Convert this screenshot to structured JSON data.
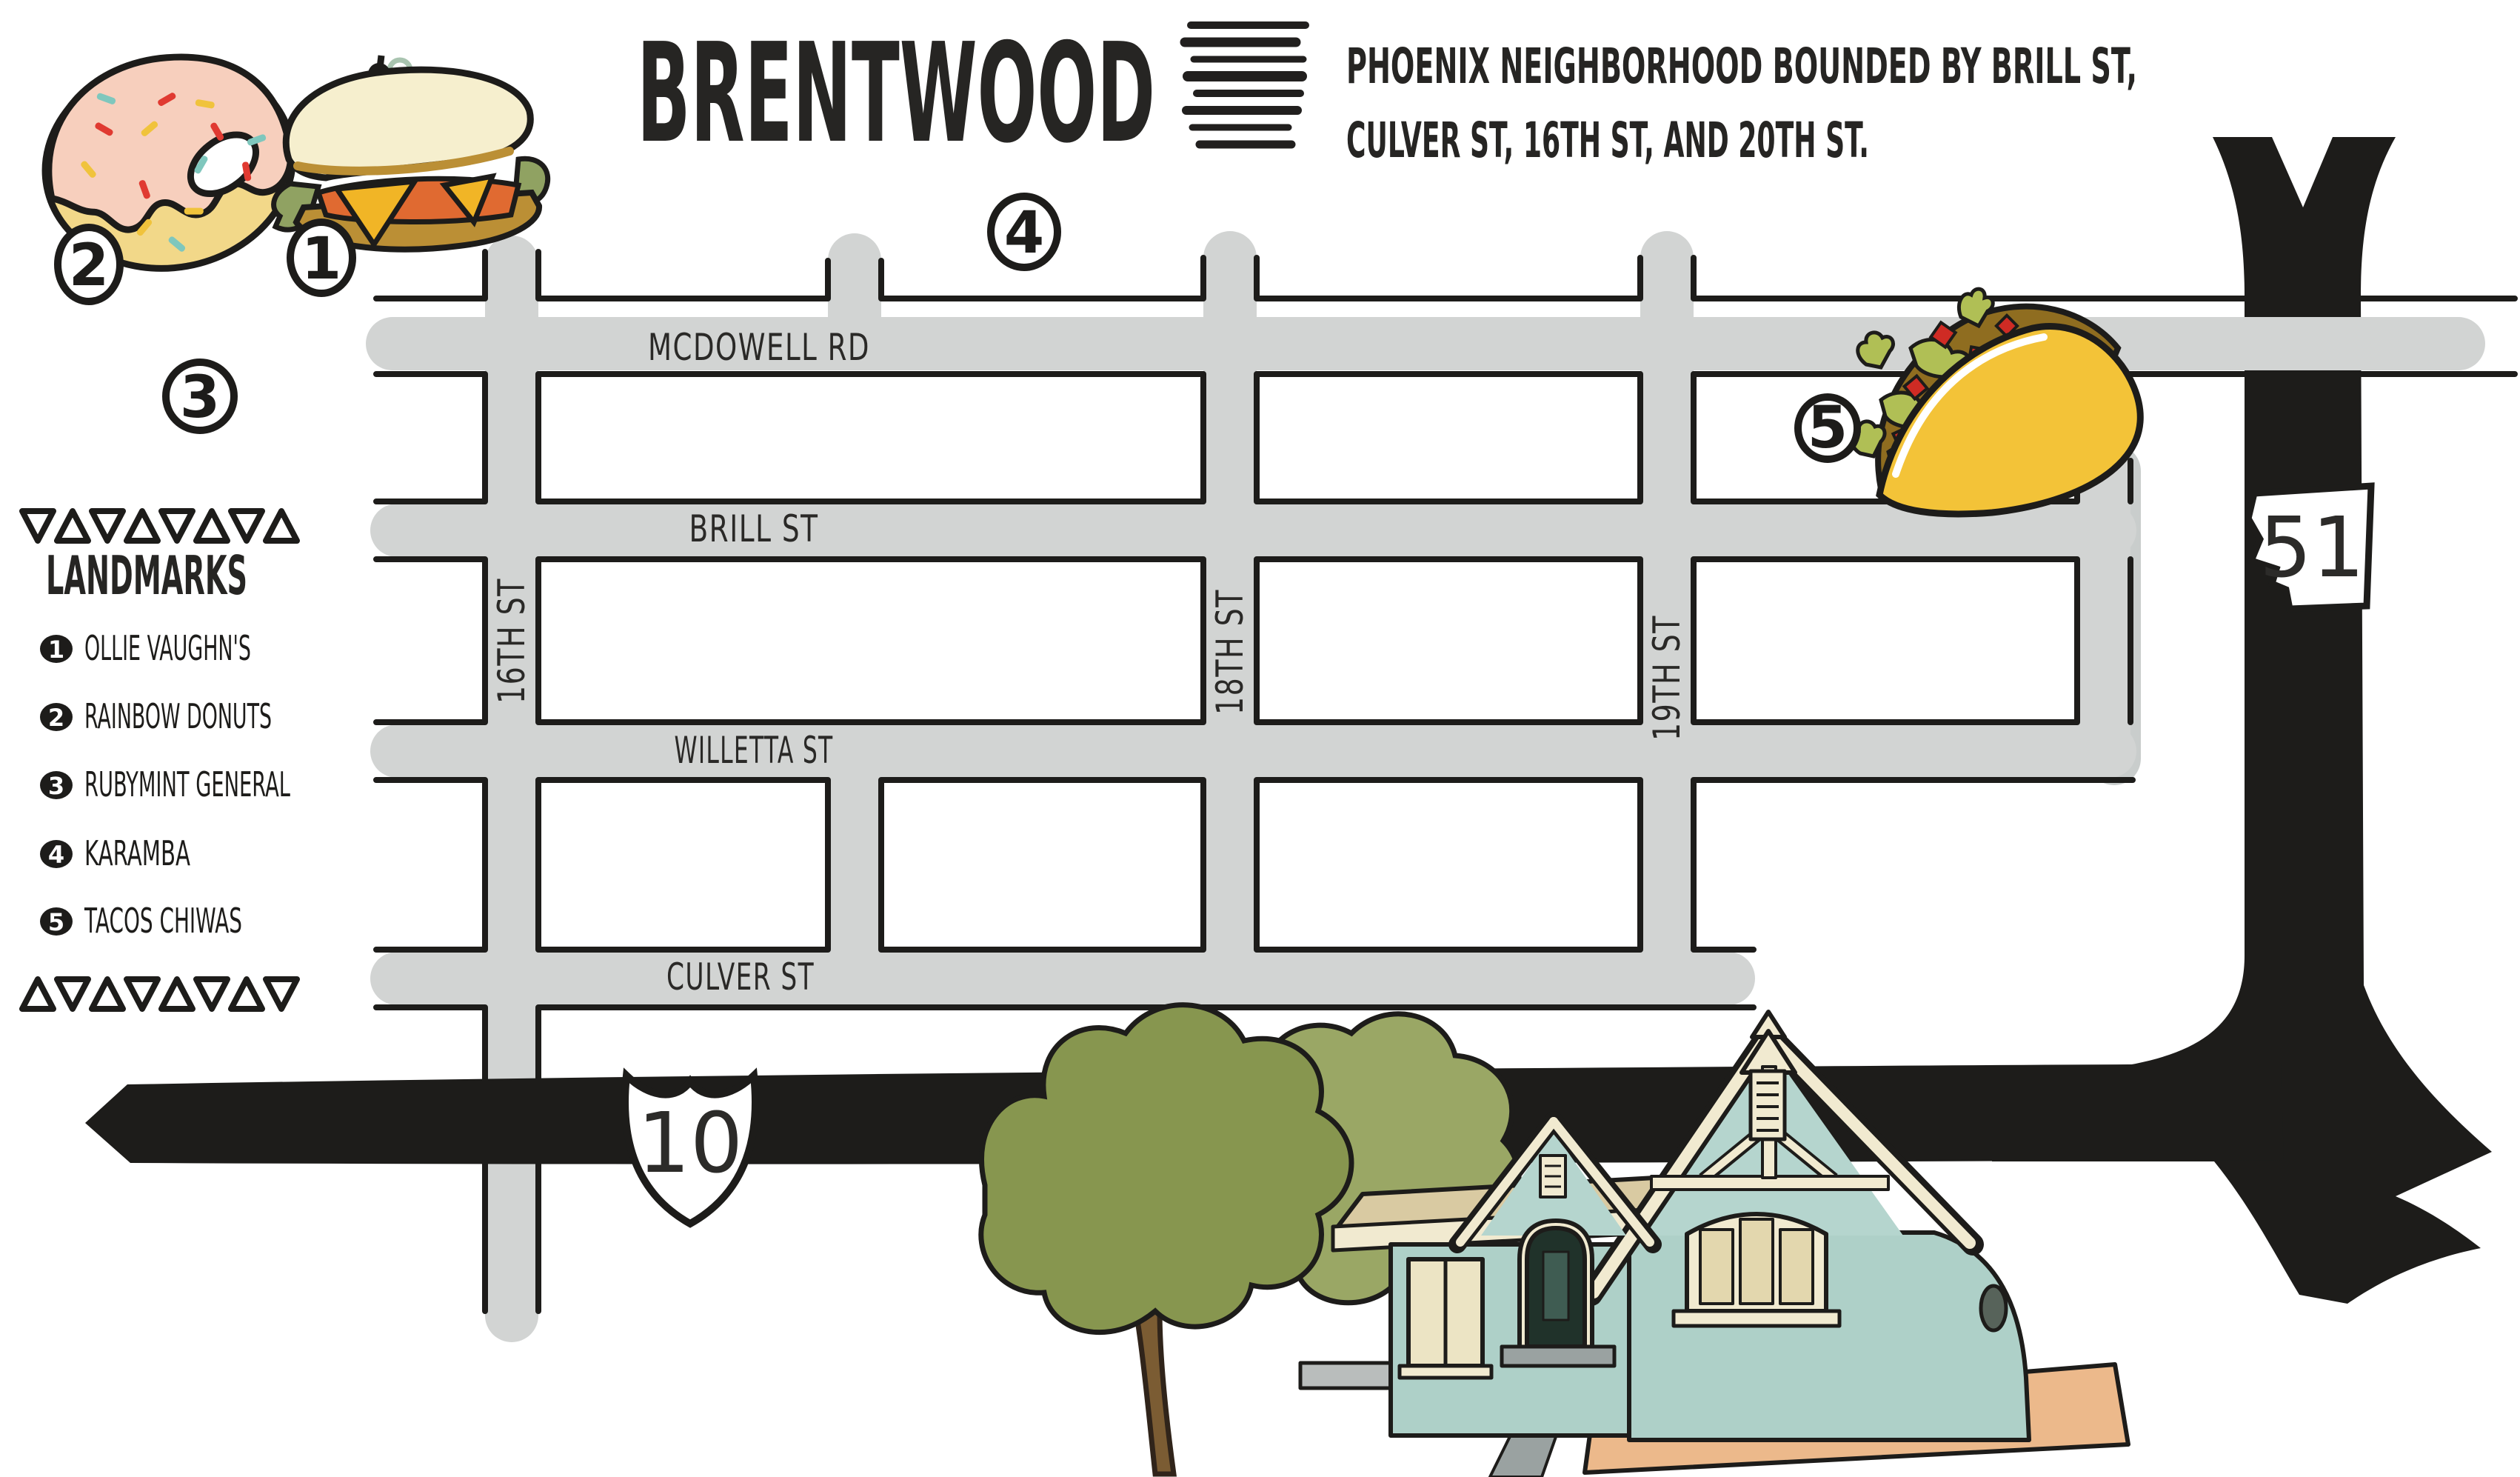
{
  "title": "BRENTWOOD",
  "subtitle": {
    "line1": "PHOENIX NEIGHBORHOOD BOUNDED BY BRILL ST,",
    "line2": "CULVER ST, 16TH ST, AND 20TH ST."
  },
  "legend": {
    "heading": "LANDMARKS",
    "items": [
      {
        "num": "1",
        "label": "OLLIE VAUGHN'S"
      },
      {
        "num": "2",
        "label": "RAINBOW DONUTS"
      },
      {
        "num": "3",
        "label": "RUBYMINT GENERAL"
      },
      {
        "num": "4",
        "label": "KARAMBA"
      },
      {
        "num": "5",
        "label": "TACOS CHIWAS"
      }
    ]
  },
  "map": {
    "streets": {
      "mcdowell": "MCDOWELL RD",
      "brill": "BRILL ST",
      "willetta": "WILLETTA ST",
      "culver": "CULVER ST",
      "st16": "16TH ST",
      "st18": "18TH ST",
      "st19": "19TH ST"
    },
    "highways": {
      "h51": "51",
      "h10": "10"
    },
    "markers": {
      "m1": "1",
      "m2": "2",
      "m3": "3",
      "m4": "4",
      "m5": "5"
    }
  },
  "colors": {
    "road_gray": "#d2d4d3",
    "road_shadow": "#c9cdcc",
    "ink_black": "#1d1c1a",
    "donut_icing": "#f7cfbd",
    "donut_dough": "#f2d889",
    "sprinkle_red": "#e03a31",
    "sprinkle_yellow": "#f0c33c",
    "sprinkle_teal": "#7fc7bd",
    "taco_shell": "#f3c338",
    "taco_filling": "#8f6d20",
    "lettuce_green": "#b0bf55",
    "tomato_red": "#cf2b24",
    "bread_cream": "#f6efce",
    "crust_brown": "#bb8f35",
    "cheese_yellow": "#f1b526",
    "sandwich_lettuce": "#90a262",
    "tomato_orange": "#e06a31",
    "garnish_pale": "#a9c4b0",
    "house_teal": "#aed0c8",
    "gable_teal": "#b5d5ce",
    "trim_cream": "#f1ead0",
    "pane_tan": "#e3d7ae",
    "roof_tan": "#d9caa2",
    "door_dark": "#20322a",
    "tree_green": "#87964f",
    "tree_green_light": "#9aa765",
    "trunk_brown": "#7b5c33",
    "driveway_tan": "#ecb98b",
    "sidewalk_gray": "#9aa2a1"
  }
}
